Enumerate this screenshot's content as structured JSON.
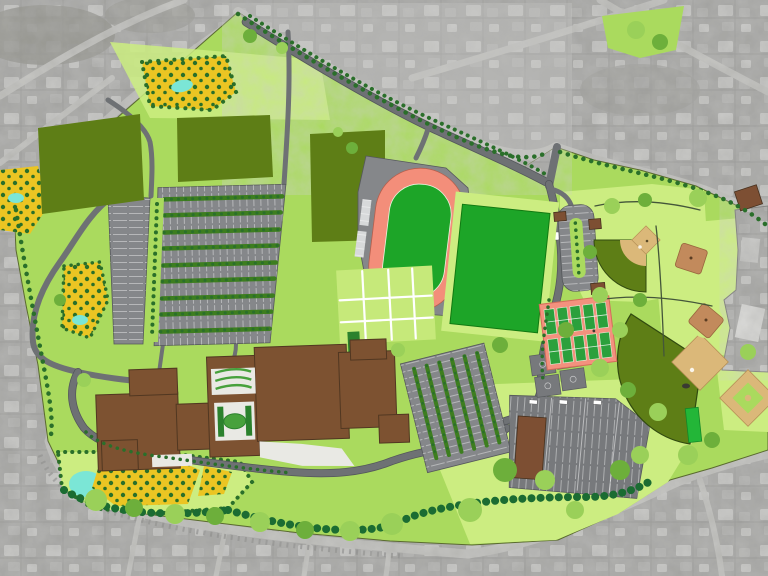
{
  "meta": {
    "label": "school-campus-site-plan-over-aerial-photo",
    "view": "top-down-site-plan-rendering",
    "visible_text": []
  },
  "palette": {
    "aerial_base": "#b2b2b0",
    "aerial_road": "#c6c6c3",
    "aerial_house": "#cacac8",
    "aerial_house2": "#bbbbb9",
    "campus_green": "#abd963",
    "light_green": "#cdec85",
    "lawn_green": "#c7e87f",
    "sports_green": "#22a32c",
    "field_olive": "#5f7d1a",
    "track_salmon": "#ef8f7c",
    "tennis_salmon": "#ef9280",
    "court_green": "#2f9e3f",
    "road_gray": "#6e7174",
    "lot_gray": "#85878a",
    "lot_dark": "#77797c",
    "plaza_white": "#e9e9e4",
    "building_brown": "#7b5233",
    "building_outline": "#503722",
    "small_brown": "#7b4f35",
    "infield_tan": "#d9b87c",
    "pad_tan": "#c08a5f",
    "orchard_yellow": "#e9c52b",
    "pond_cyan": "#7fe5d6",
    "hedge_green": "#1e6b34",
    "tree_dark": "#2c6e2c",
    "tree_mid": "#6fae3f",
    "tree_light": "#9ccf5e",
    "cage_green": "#28b43c"
  },
  "features": [
    {
      "name": "surrounding-neighborhood-aerial",
      "fill": "aerial_base"
    },
    {
      "name": "campus-grounds",
      "fill": "campus_green"
    },
    {
      "name": "practice-fields",
      "count": 3,
      "fill": "field_olive"
    },
    {
      "name": "running-track",
      "fill": "track_salmon",
      "infield": "sports_green"
    },
    {
      "name": "multipurpose-field",
      "fill": "sports_green"
    },
    {
      "name": "tennis-court-complex",
      "courts": 10,
      "fill": "tennis_salmon",
      "court": "court_green"
    },
    {
      "name": "basketball-courts",
      "count": 4,
      "fill": "lot_dark"
    },
    {
      "name": "baseball-field-upper",
      "fill": "field_olive",
      "infield": "infield_tan"
    },
    {
      "name": "softball-field",
      "fill": "field_olive",
      "infield": "infield_tan"
    },
    {
      "name": "baseball-diamond-east",
      "fill": "infield_tan"
    },
    {
      "name": "practice-pads",
      "count": 2,
      "fill": "pad_tan"
    },
    {
      "name": "school-building-complex",
      "fill": "building_brown"
    },
    {
      "name": "main-parking-lot",
      "rows": 9,
      "fill": "lot_gray"
    },
    {
      "name": "strip-parking-lot",
      "fill": "lot_gray"
    },
    {
      "name": "mid-parking-lot",
      "fill": "lot_gray"
    },
    {
      "name": "south-parking-lot",
      "fill": "lot_dark"
    },
    {
      "name": "parking-loop",
      "fill": "lot_gray"
    },
    {
      "name": "orchard-gardens",
      "count": 4,
      "fill": "orchard_yellow"
    },
    {
      "name": "ponds",
      "count": 5,
      "fill": "pond_cyan"
    },
    {
      "name": "tree-hedges",
      "fill": "hedge_green"
    },
    {
      "name": "internal-roads",
      "fill": "road_gray"
    }
  ]
}
